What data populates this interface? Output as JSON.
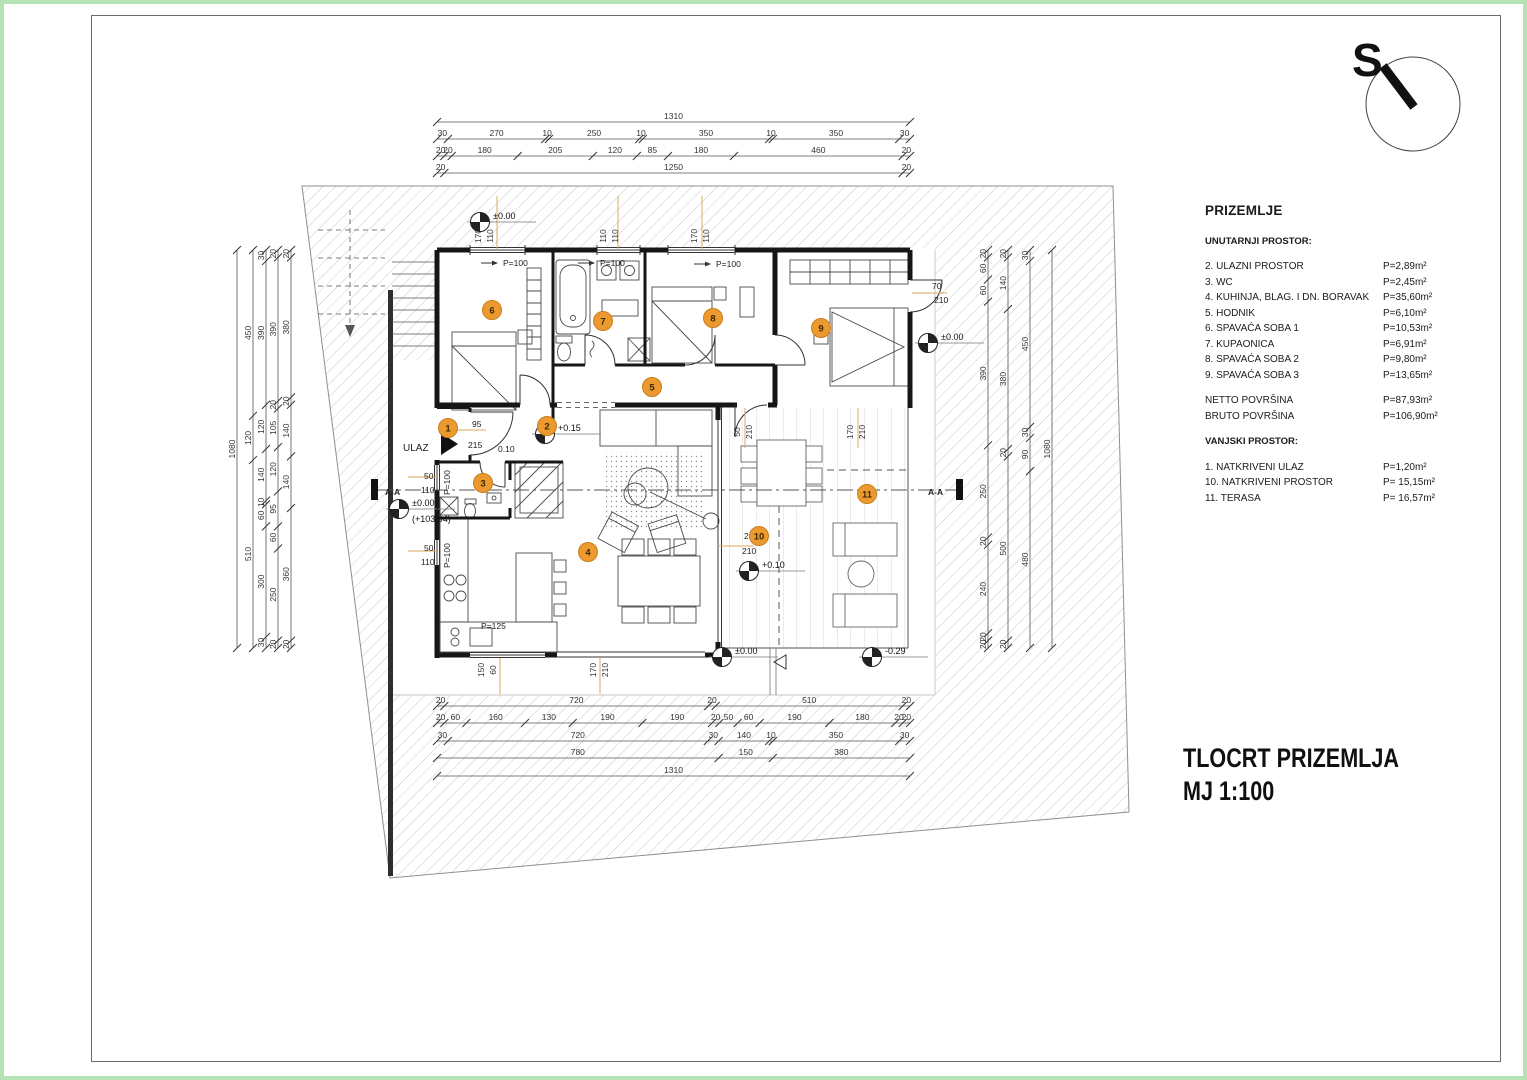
{
  "colors": {
    "accent_orange": "#EC9A30",
    "orange_border": "#c97f1d",
    "hatch": "#c9c9c9",
    "green_frame": "#b5e3b5",
    "wall": "#161616",
    "dim_text": "#333333",
    "leader": "#d8a85f"
  },
  "north": {
    "label": "S"
  },
  "legend": {
    "title": "PRIZEMLJE",
    "interior_heading": "UNUTARNJI PROSTOR:",
    "interior_rows": [
      {
        "label": "2. ULAZNI PROSTOR",
        "value": "P=2,89m²"
      },
      {
        "label": "3. WC",
        "value": "P=2,45m²"
      },
      {
        "label": "4. KUHINJA, BLAG. I DN. BORAVAK",
        "value": "P=35,60m²"
      },
      {
        "label": "5. HODNIK",
        "value": "P=6,10m²"
      },
      {
        "label": "6. SPAVAĆA SOBA 1",
        "value": "P=10,53m²"
      },
      {
        "label": "7. KUPAONICA",
        "value": "P=6,91m²"
      },
      {
        "label": "8. SPAVAĆA SOBA 2",
        "value": "P=9,80m²"
      },
      {
        "label": "9. SPAVAĆA SOBA 3",
        "value": "P=13,65m²"
      }
    ],
    "totals": [
      {
        "label": "NETTO POVRŠINA",
        "value": "P=87,93m²"
      },
      {
        "label": "BRUTO POVRŠINA",
        "value": "P=106,90m²"
      }
    ],
    "exterior_heading": "VANJSKI PROSTOR:",
    "exterior_rows": [
      {
        "label": "1. NATKRIVENI ULAZ",
        "value": "P=1,20m²"
      },
      {
        "label": "10. NATKRIVENI PROSTOR",
        "value": "P= 15,15m²"
      },
      {
        "label": "11. TERASA",
        "value": "P= 16,57m²"
      }
    ]
  },
  "title_block": {
    "line1": "TLOCRT PRIZEMLJA",
    "line2": "MJ 1:100"
  },
  "plan": {
    "rooms": [
      {
        "n": "1",
        "x": 448,
        "y": 428
      },
      {
        "n": "2",
        "x": 547,
        "y": 426
      },
      {
        "n": "3",
        "x": 483,
        "y": 483
      },
      {
        "n": "4",
        "x": 588,
        "y": 552
      },
      {
        "n": "5",
        "x": 652,
        "y": 387
      },
      {
        "n": "6",
        "x": 492,
        "y": 310
      },
      {
        "n": "7",
        "x": 603,
        "y": 321
      },
      {
        "n": "8",
        "x": 713,
        "y": 318
      },
      {
        "n": "9",
        "x": 821,
        "y": 328
      },
      {
        "n": "10",
        "x": 759,
        "y": 536
      },
      {
        "n": "11",
        "x": 867,
        "y": 494
      }
    ],
    "dim_chains": [
      {
        "side": "top",
        "pos": 122,
        "labels": [
          "1310"
        ]
      },
      {
        "side": "top",
        "pos": 139,
        "labels": [
          "30",
          "270",
          "10",
          "250",
          "10",
          "350",
          "10",
          "350",
          "30"
        ]
      },
      {
        "side": "top",
        "pos": 156,
        "labels": [
          "20",
          "20",
          "180",
          "205",
          "120",
          "85",
          "180",
          "460",
          "20"
        ]
      },
      {
        "side": "top",
        "pos": 173,
        "labels": [
          "20",
          "1250",
          "20"
        ]
      },
      {
        "side": "bottom",
        "pos": 706,
        "labels": [
          "20",
          "720",
          "20",
          "510",
          "20"
        ]
      },
      {
        "side": "bottom",
        "pos": 723,
        "labels": [
          "20",
          "60",
          "160",
          "130",
          "190",
          "190",
          "20",
          "50",
          "60",
          "190",
          "180",
          "20",
          "20"
        ]
      },
      {
        "side": "bottom",
        "pos": 741,
        "labels": [
          "30",
          "720",
          "30",
          "140",
          "10",
          "350",
          "30"
        ]
      },
      {
        "side": "bottom",
        "pos": 758,
        "labels": [
          "780",
          "150",
          "380"
        ]
      },
      {
        "side": "bottom",
        "pos": 776,
        "labels": [
          "1310"
        ]
      },
      {
        "side": "left",
        "pos": 237,
        "labels": [
          "1080"
        ]
      },
      {
        "side": "left",
        "pos": 253,
        "labels": [
          "450",
          "120",
          "510"
        ]
      },
      {
        "side": "left",
        "pos": 266,
        "labels": [
          "30",
          "390",
          "120",
          "140",
          "10",
          "60",
          "300",
          "30"
        ]
      },
      {
        "side": "left",
        "pos": 278,
        "labels": [
          "20",
          "390",
          "20",
          "105",
          "120",
          "95",
          "60",
          "250",
          "20"
        ]
      },
      {
        "side": "left",
        "pos": 291,
        "labels": [
          "20",
          "380",
          "20",
          "140",
          "140",
          "360",
          "20"
        ]
      },
      {
        "side": "right",
        "pos": 988,
        "labels": [
          "20",
          "60",
          "60",
          "390",
          "250",
          "20",
          "240",
          "20",
          "20"
        ]
      },
      {
        "side": "right",
        "pos": 1008,
        "labels": [
          "20",
          "140",
          "380",
          "20",
          "500",
          "20"
        ]
      },
      {
        "side": "right",
        "pos": 1030,
        "labels": [
          "30",
          "450",
          "30",
          "90",
          "480"
        ]
      },
      {
        "side": "right",
        "pos": 1052,
        "labels": [
          "1080"
        ]
      }
    ],
    "window_dims": [
      {
        "x": 486,
        "y": 236,
        "a": "170",
        "b": "110"
      },
      {
        "x": 611,
        "y": 236,
        "a": "110",
        "b": "110"
      },
      {
        "x": 702,
        "y": 236,
        "a": "170",
        "b": "110"
      },
      {
        "x": 489,
        "y": 670,
        "a": "150",
        "b": "60"
      },
      {
        "x": 601,
        "y": 670,
        "a": "170",
        "b": "210"
      },
      {
        "x": 745,
        "y": 432,
        "a": "50",
        "b": "210"
      },
      {
        "x": 858,
        "y": 432,
        "a": "170",
        "b": "210"
      }
    ],
    "texts": [
      {
        "t": "P=100",
        "x": 503,
        "y": 266
      },
      {
        "t": "P=100",
        "x": 600,
        "y": 266
      },
      {
        "t": "P=100",
        "x": 716,
        "y": 267
      },
      {
        "t": "P=100",
        "x": 450,
        "y": 495,
        "rot": -90
      },
      {
        "t": "P=100",
        "x": 450,
        "y": 568,
        "rot": -90
      },
      {
        "t": "P=125",
        "x": 481,
        "y": 629
      },
      {
        "t": "70",
        "x": 932,
        "y": 289
      },
      {
        "t": "210",
        "x": 934,
        "y": 303
      },
      {
        "t": "50",
        "x": 424,
        "y": 479
      },
      {
        "t": "110",
        "x": 421,
        "y": 493
      },
      {
        "t": "50",
        "x": 424,
        "y": 551
      },
      {
        "t": "110",
        "x": 421,
        "y": 565
      },
      {
        "t": "95",
        "x": 472,
        "y": 427
      },
      {
        "t": "215",
        "x": 468,
        "y": 448
      },
      {
        "t": "0.10",
        "x": 498,
        "y": 452
      },
      {
        "t": "240",
        "x": 744,
        "y": 539
      },
      {
        "t": "210",
        "x": 742,
        "y": 554
      },
      {
        "t": "ULAZ",
        "x": 403,
        "y": 451,
        "size": 10
      },
      {
        "t": "A-A",
        "x": 385,
        "y": 495,
        "bold": true
      },
      {
        "t": "A-A",
        "x": 928,
        "y": 495,
        "bold": true
      }
    ],
    "levels": [
      {
        "t": "±0.00",
        "x": 480,
        "y": 222
      },
      {
        "t": "+0.15",
        "x": 545,
        "y": 434
      },
      {
        "t": "±0.00",
        "sub": "(+103,94)",
        "x": 399,
        "y": 509
      },
      {
        "t": "+0.10",
        "x": 749,
        "y": 571
      },
      {
        "t": "±0.00",
        "x": 722,
        "y": 657
      },
      {
        "t": "-0.29",
        "x": 872,
        "y": 657
      },
      {
        "t": "±0.00",
        "x": 928,
        "y": 343
      }
    ],
    "leaders": [
      [
        497,
        196,
        497,
        250
      ],
      [
        618,
        196,
        618,
        250
      ],
      [
        702,
        196,
        702,
        250
      ],
      [
        500,
        658,
        500,
        694
      ],
      [
        600,
        658,
        600,
        694
      ],
      [
        745,
        408,
        745,
        448
      ],
      [
        858,
        408,
        858,
        448
      ],
      [
        912,
        293,
        947,
        293
      ],
      [
        408,
        477,
        437,
        477
      ],
      [
        408,
        551,
        437,
        551
      ],
      [
        452,
        430,
        486,
        430
      ],
      [
        718,
        546,
        754,
        546
      ]
    ]
  }
}
